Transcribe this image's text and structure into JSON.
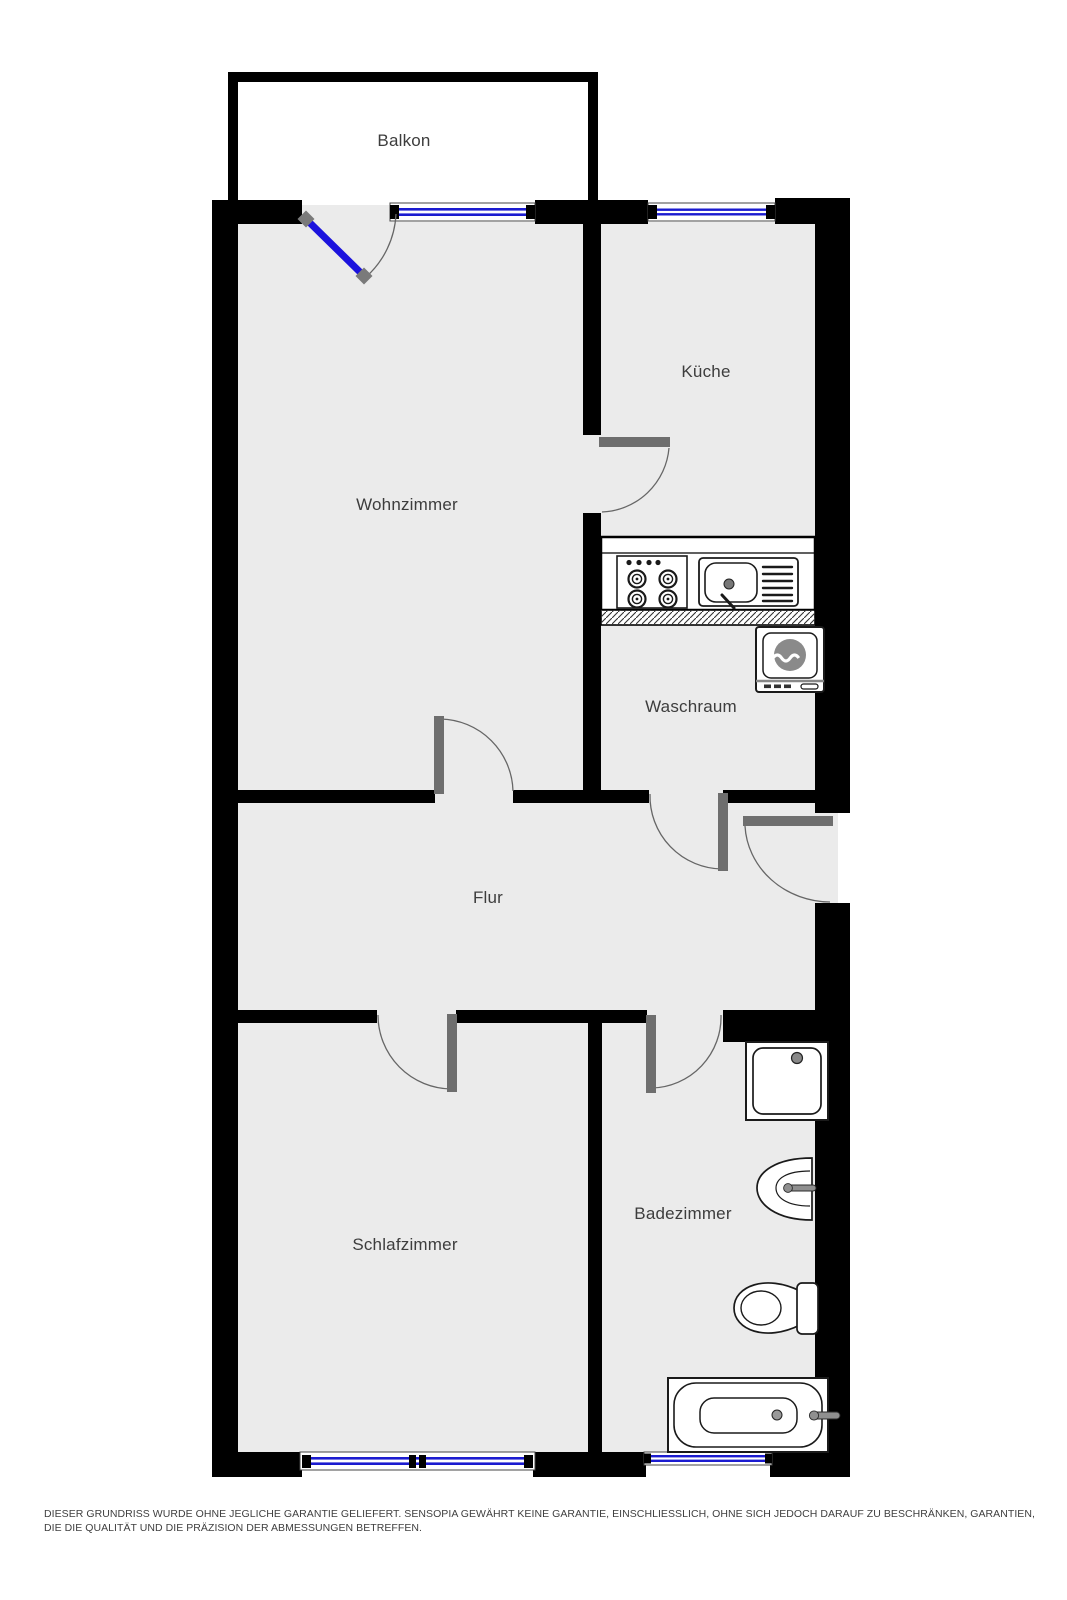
{
  "page": {
    "type": "apartment-floor-plan"
  },
  "rooms": {
    "balkon": {
      "label": "Balkon"
    },
    "wohnzimmer": {
      "label": "Wohnzimmer"
    },
    "kueche": {
      "label": "Küche"
    },
    "waschraum": {
      "label": "Waschraum"
    },
    "flur": {
      "label": "Flur"
    },
    "schlafzimmer": {
      "label": "Schlafzimmer"
    },
    "badezimmer": {
      "label": "Badezimmer"
    }
  },
  "fixtures": [
    "balcony-door",
    "stove",
    "kitchen-sink",
    "washing-machine",
    "shower",
    "washbasin",
    "toilet",
    "bathtub"
  ],
  "doors": [
    "balcony-door",
    "kitchen-door",
    "living-room-door",
    "laundry-door",
    "entrance-door",
    "bedroom-door",
    "bathroom-door"
  ],
  "windows": [
    "living-room-window",
    "kitchen-window",
    "bedroom-window",
    "bathroom-window"
  ],
  "footer": {
    "disclaimer": "DIESER GRUNDRISS WURDE OHNE JEGLICHE GARANTIE GELIEFERT. SENSOPIA GEWÄHRT KEINE GARANTIE, EINSCHLIESSLICH, OHNE SICH JEDOCH DARAUF ZU BESCHRÄNKEN, GARANTIEN, DIE DIE QUALITÄT UND DIE PRÄZISION DER ABMESSUNGEN BETREFFEN."
  },
  "colors": {
    "background": "#ffffff",
    "wall": "#000000",
    "floor": "#ebebeb",
    "window_glass": "#1b1bd0",
    "balcony_door_leaf": "#1b12dd",
    "door_jamb": "#6e6e6e",
    "arc_line": "#666666",
    "fixture_outline": "#1a1a1a",
    "drum_gray": "#8a8a8a",
    "label_text": "#3d3d3d",
    "disclaimer_text": "#3f3f3f"
  }
}
